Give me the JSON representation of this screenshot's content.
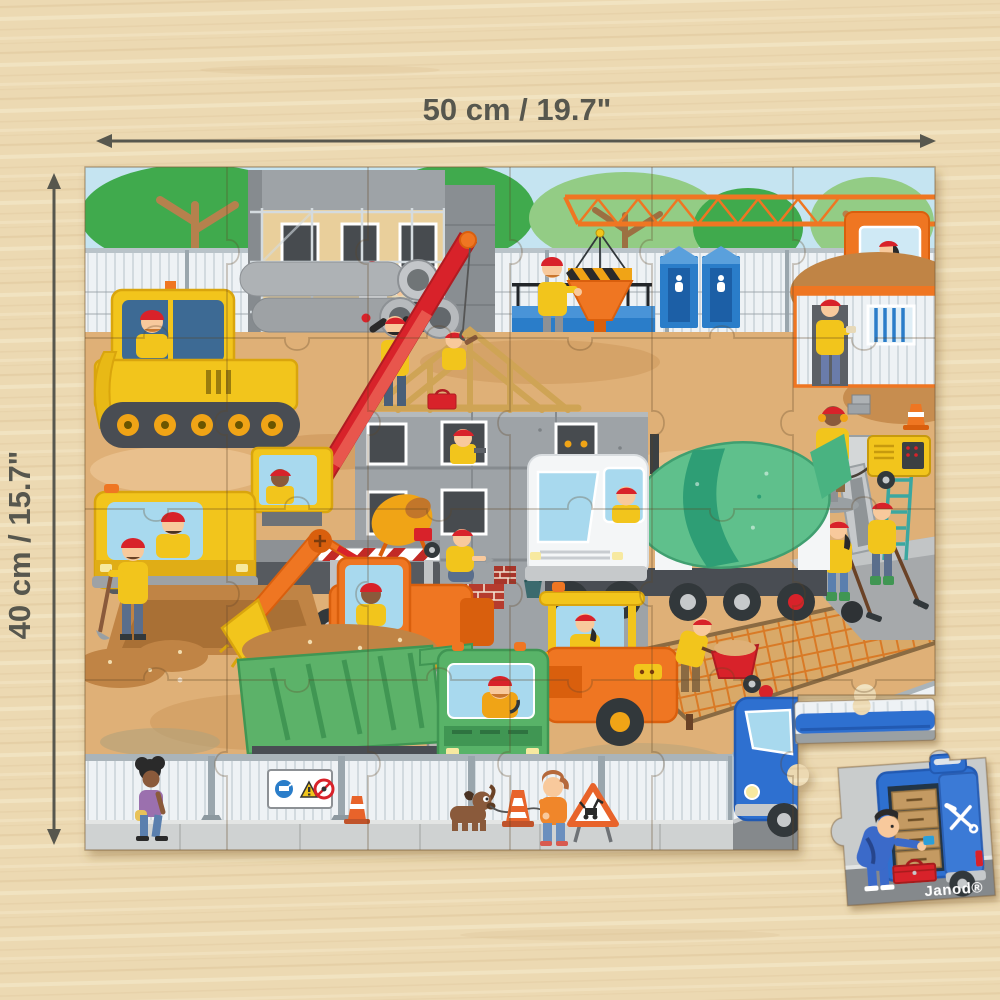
{
  "dimension_annotations": {
    "width_label": "50 cm / 19.7\"",
    "height_label": "40 cm / 15.7\""
  },
  "puzzle_piece": {
    "brand_label": "Janod®",
    "tools_icon": "crossed-hammer-and-wrench"
  },
  "scene": {
    "description_names": [
      "wood-table-background",
      "construction-puzzle",
      "sky",
      "trees",
      "site-hoarding-fence",
      "tower-crane",
      "crane-operator",
      "hazard-stripe-panel",
      "building-with-scaffolding",
      "painter-worker",
      "concrete-building",
      "window-worker",
      "roof-truss",
      "roof-workers",
      "blue-container",
      "hopper-funnel",
      "portable-toilets",
      "site-office-container",
      "worker-eating",
      "dirt-mounds",
      "bulldozer",
      "concrete-pipes",
      "mobile-crane-truck",
      "red-crane-boom",
      "cement-mixer-truck",
      "excavator",
      "dump-truck",
      "road-roller",
      "wheelbarrow-worker",
      "jackhammer-worker",
      "generator",
      "rebar-mesh-slab",
      "wet-concrete",
      "raking-workers",
      "mason-worker",
      "brick-wall",
      "portable-mixer",
      "shovel-worker",
      "dig-pit",
      "bottom-fence",
      "safety-signs-panel",
      "pedestrian-woman",
      "boy-with-dog",
      "dog",
      "roadworks-sign",
      "traffic-cones",
      "sidewalk",
      "road",
      "blue-van",
      "detached-roof-strip-piece",
      "detached-corner-piece",
      "mechanic",
      "toolbox"
    ]
  },
  "colors": {
    "wood": "#ecd9b2",
    "woodDark": "#d6ba8c",
    "woodLight": "#f6ebcd",
    "dim": "#57574e",
    "sky": "#c5e4f1",
    "treeGreen": "#3faa4e",
    "treeLight": "#93cc85",
    "trunk": "#b5814e",
    "fenceWhite": "#eef2f5",
    "fenceLine": "#d2dadf",
    "fencePost": "#9aa6ad",
    "dirt": "#dfb077",
    "dirtDark": "#c08445",
    "dirtLight": "#ecc897",
    "dirtOlive": "#b3a27c",
    "concrete": "#9ea3a7",
    "concreteDark": "#868b8f",
    "concreteDarker": "#6e7276",
    "windowDark": "#474c50",
    "beige": "#e9cf9b",
    "red": "#d8232a",
    "redDark": "#b01b21",
    "yellow": "#f2c51d",
    "yellowDark": "#d9a50e",
    "orange": "#ef7622",
    "orangeDark": "#d95f10",
    "amber": "#f0a419",
    "green": "#5cb269",
    "greenDark": "#3f9653",
    "drumGreen": "#5fc08c",
    "drumDark": "#2e9e74",
    "blue": "#2a7dc9",
    "blueDark": "#1e5fa6",
    "vanBlue": "#2f6fd0",
    "teal": "#3aa7a0",
    "skin": "#f8c99c",
    "skinDark": "#8a5a3b",
    "road": "#85898c",
    "sidewalk": "#cfd2d2",
    "steel": "#c6c9cb",
    "steelDark": "#4a4e52",
    "glass": "#a8d9ee",
    "white": "#ffffff"
  }
}
